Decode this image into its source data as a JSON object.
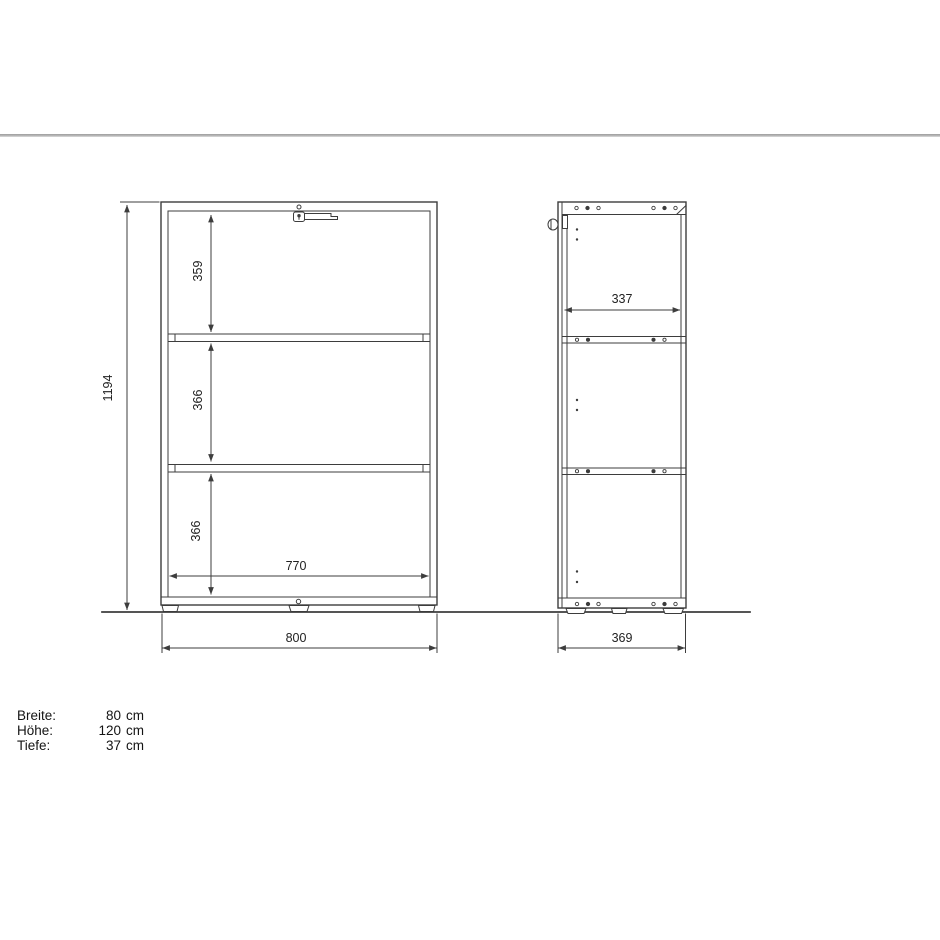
{
  "drawing": {
    "front_view": {
      "total_height": "1194",
      "compartment_top": "359",
      "compartment_middle": "366",
      "compartment_bottom": "366",
      "inner_width": "770",
      "outer_width": "800"
    },
    "side_view": {
      "inner_depth": "337",
      "outer_depth": "369"
    }
  },
  "specs": {
    "rows": [
      {
        "label": "Breite:",
        "value": "80",
        "unit": "cm"
      },
      {
        "label": "Höhe:",
        "value": "120",
        "unit": "cm"
      },
      {
        "label": "Tiefe:",
        "value": "37",
        "unit": "cm"
      }
    ]
  },
  "colors": {
    "line": "#3d3d3d",
    "separator": "#b0b0b0",
    "text": "#222222",
    "background": "#ffffff"
  }
}
